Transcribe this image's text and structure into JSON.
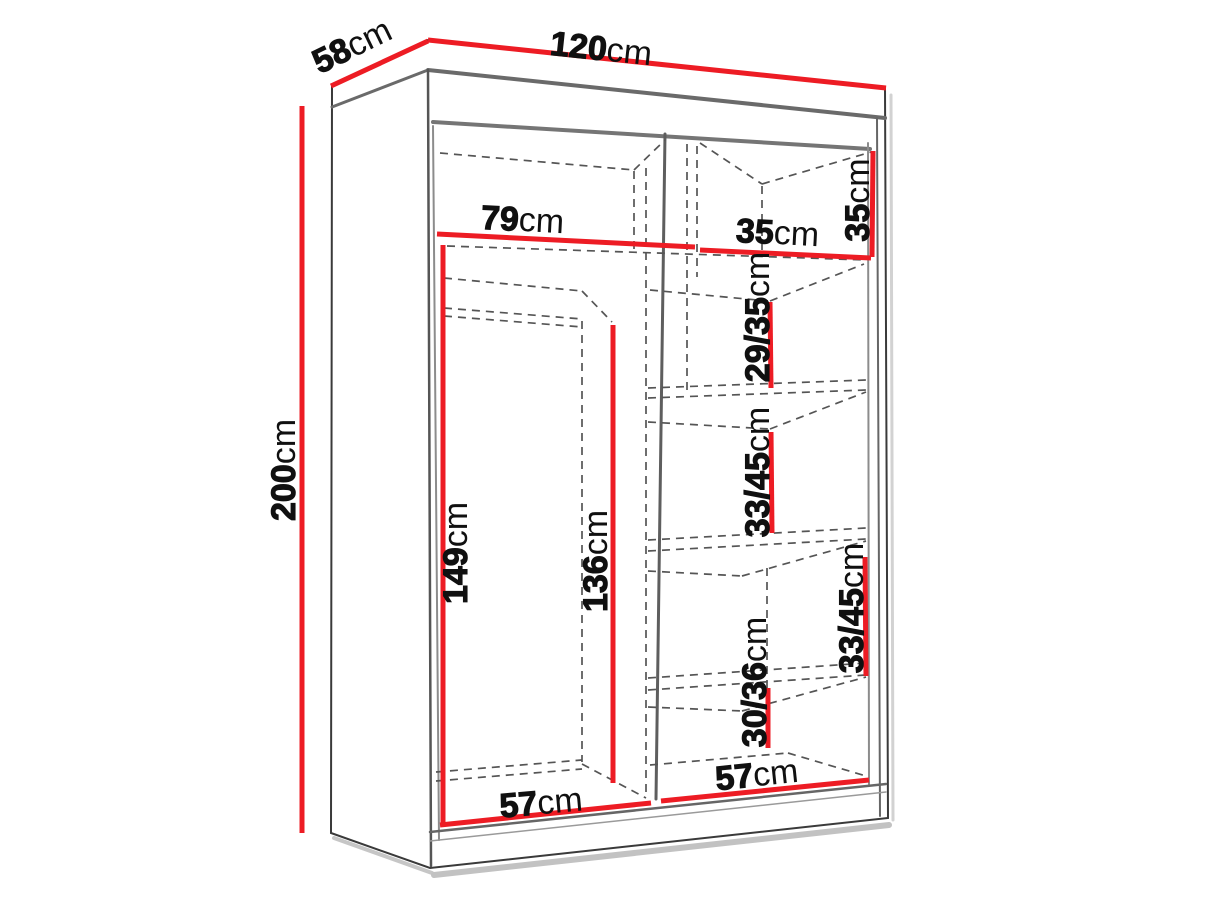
{
  "diagram": {
    "title": "wardrobe-dimension-diagram",
    "unit": "cm",
    "accent_color": "#ed1c24",
    "line_color": "#3a3a3a",
    "dash_color": "#555555",
    "background": "#ffffff"
  },
  "dimensions": {
    "width": {
      "num": "120",
      "unit": "cm"
    },
    "depth": {
      "num": "58",
      "unit": "cm"
    },
    "height": {
      "num": "200",
      "unit": "cm"
    },
    "top_left_inner_width": {
      "num": "79",
      "unit": "cm"
    },
    "top_right_inner_width": {
      "num": "35",
      "unit": "cm"
    },
    "top_right_inner_height": {
      "num": "35",
      "unit": "cm"
    },
    "right_shelf_1_height": {
      "num": "29/35",
      "unit": "cm"
    },
    "right_shelf_2_height": {
      "num": "33/45",
      "unit": "cm"
    },
    "right_shelf_3_height": {
      "num": "33/45",
      "unit": "cm"
    },
    "right_shelf_4_height": {
      "num": "30/36",
      "unit": "cm"
    },
    "left_inner_height": {
      "num": "149",
      "unit": "cm"
    },
    "left_inner_back_height": {
      "num": "136",
      "unit": "cm"
    },
    "bottom_left_inner_width": {
      "num": "57",
      "unit": "cm"
    },
    "bottom_right_inner_width": {
      "num": "57",
      "unit": "cm"
    }
  }
}
